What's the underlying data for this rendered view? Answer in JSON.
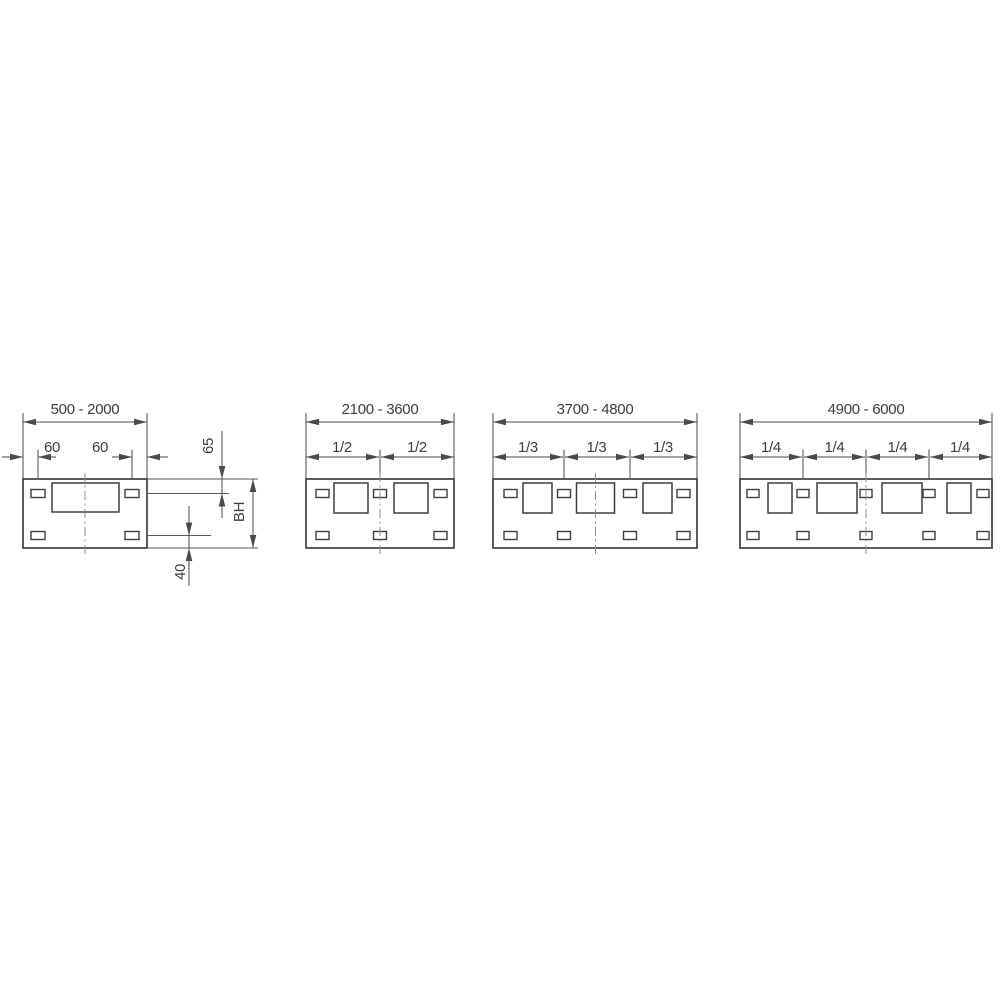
{
  "figure": {
    "type": "technical-dimension-drawing",
    "background": "#ffffff",
    "line_color": "#4a4a4a",
    "text_color": "#3d3d3d",
    "diagrams": [
      {
        "range_label": "500 - 2000",
        "offset_left": "60",
        "offset_right": "60",
        "top_slot_dim": "65",
        "height_dim": "BH",
        "bottom_slot_dim": "40"
      },
      {
        "range_label": "2100 - 3600",
        "fractions": [
          "1/2",
          "1/2"
        ]
      },
      {
        "range_label": "3700 - 4800",
        "fractions": [
          "1/3",
          "1/3",
          "1/3"
        ]
      },
      {
        "range_label": "4900 - 6000",
        "fractions": [
          "1/4",
          "1/4",
          "1/4",
          "1/4"
        ]
      }
    ]
  }
}
